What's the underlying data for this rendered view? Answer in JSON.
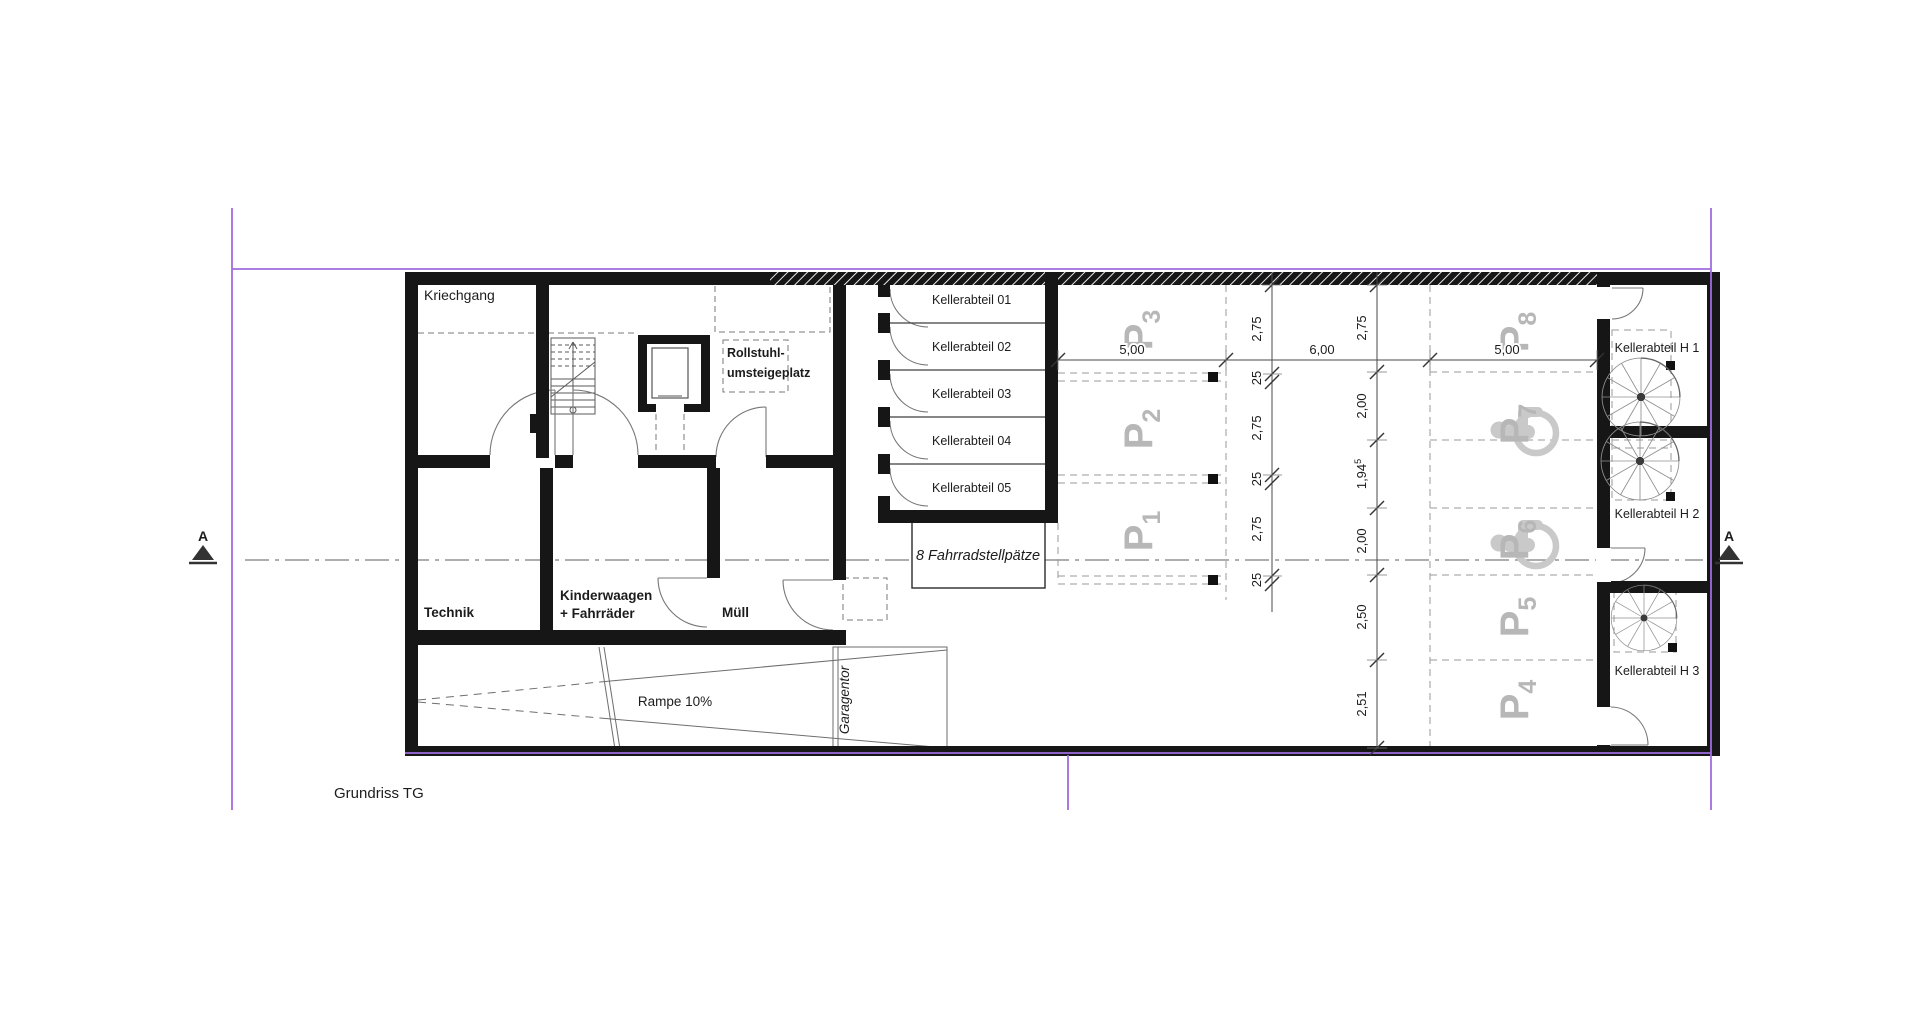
{
  "drawing_title": "Grundriss TG",
  "section_marker": "A",
  "rooms": {
    "kriechgang": "Kriechgang",
    "technik": "Technik",
    "kinderwagen_1": "Kinderwaagen",
    "kinderwagen_2": "+ Fahrräder",
    "muell": "Müll",
    "rollstuhl_1": "Rollstuhl-",
    "rollstuhl_2": "umsteigeplatz",
    "fahrrad": "8 Fahrradstellpätze",
    "rampe": "Rampe 10%",
    "garagentor": "Garagentor"
  },
  "keller_cells": [
    "Kellerabteil 01",
    "Kellerabteil 02",
    "Kellerabteil 03",
    "Kellerabteil 04",
    "Kellerabteil 05"
  ],
  "keller_h": [
    "Kellerabteil H 1",
    "Kellerabteil H 2",
    "Kellerabteil H 3"
  ],
  "stalls": [
    {
      "p": "P",
      "n": "1"
    },
    {
      "p": "P",
      "n": "2"
    },
    {
      "p": "P",
      "n": "3"
    },
    {
      "p": "P",
      "n": "4"
    },
    {
      "p": "P",
      "n": "5"
    },
    {
      "p": "P",
      "n": "6"
    },
    {
      "p": "P",
      "n": "7"
    },
    {
      "p": "P",
      "n": "8"
    }
  ],
  "dims": {
    "horizontal": [
      "5,00",
      "6,00",
      "5,00"
    ],
    "left_chain": [
      "2,75",
      "25",
      "2,75",
      "25",
      "2,75",
      "25"
    ],
    "right_chain": [
      {
        "v": "2,75"
      },
      {
        "v": "2,00"
      },
      {
        "v": "1,94",
        "sup": "5"
      },
      {
        "v": "2,00"
      },
      {
        "v": "2,50"
      },
      {
        "v": "2,51"
      }
    ]
  },
  "colors": {
    "boundary": "#a06ce0",
    "wall": "#161616",
    "stall_text": "#b7b7b7",
    "icon_grey": "#c9c9c9"
  }
}
